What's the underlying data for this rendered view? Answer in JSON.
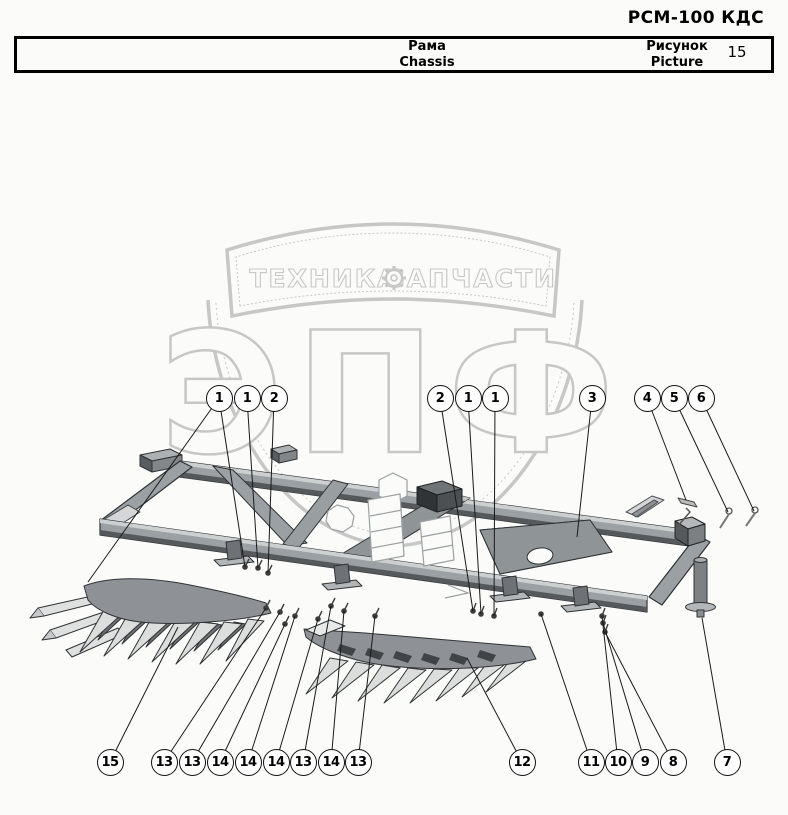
{
  "header": {
    "title": "РСМ-100 КДС"
  },
  "info_table": {
    "part_name_ru": "Рама",
    "part_name_en": "Chassis",
    "figure_label_ru": "Рисунок",
    "figure_label_en": "Picture",
    "figure_number": "15"
  },
  "watermark": {
    "banner_left": "ТЕХНИКА",
    "banner_right": "ЗАПЧАСТИ",
    "logo_text": "ЭПФ",
    "gear_icon": "gear",
    "color": "#c7c7c7"
  },
  "colors": {
    "frame": "#9aa0a3",
    "frame_dark": "#5b5f62",
    "frame_light": "#cdd0d1",
    "outline": "#2f3336",
    "leader": "#1a1a1a",
    "teeth_light": "#dcdedd",
    "teeth_dark": "#6d7174"
  },
  "callouts": [
    {
      "label": "1",
      "x": 219,
      "y": 398,
      "targets": [
        [
          245,
          567
        ],
        [
          88,
          582
        ]
      ]
    },
    {
      "label": "1",
      "x": 247,
      "y": 398,
      "targets": [
        [
          258,
          568
        ]
      ]
    },
    {
      "label": "2",
      "x": 274,
      "y": 398,
      "targets": [
        [
          268,
          573
        ]
      ]
    },
    {
      "label": "2",
      "x": 440,
      "y": 398,
      "targets": [
        [
          473,
          611
        ]
      ]
    },
    {
      "label": "1",
      "x": 468,
      "y": 398,
      "targets": [
        [
          481,
          614
        ]
      ]
    },
    {
      "label": "1",
      "x": 495,
      "y": 398,
      "targets": [
        [
          494,
          616
        ]
      ]
    },
    {
      "label": "3",
      "x": 592,
      "y": 398,
      "targets": [
        [
          577,
          537
        ]
      ]
    },
    {
      "label": "4",
      "x": 647,
      "y": 398,
      "targets": [
        [
          686,
          500
        ]
      ]
    },
    {
      "label": "5",
      "x": 674,
      "y": 398,
      "targets": [
        [
          728,
          512
        ]
      ]
    },
    {
      "label": "6",
      "x": 701,
      "y": 398,
      "targets": [
        [
          754,
          511
        ]
      ]
    },
    {
      "label": "15",
      "x": 110,
      "y": 762,
      "targets": [
        [
          178,
          627
        ]
      ]
    },
    {
      "label": "13",
      "x": 164,
      "y": 762,
      "targets": [
        [
          266,
          608
        ]
      ]
    },
    {
      "label": "13",
      "x": 192,
      "y": 762,
      "targets": [
        [
          280,
          612
        ]
      ]
    },
    {
      "label": "14",
      "x": 220,
      "y": 762,
      "targets": [
        [
          285,
          624
        ]
      ]
    },
    {
      "label": "14",
      "x": 248,
      "y": 762,
      "targets": [
        [
          295,
          616
        ]
      ]
    },
    {
      "label": "14",
      "x": 276,
      "y": 762,
      "targets": [
        [
          318,
          619
        ]
      ]
    },
    {
      "label": "13",
      "x": 303,
      "y": 762,
      "targets": [
        [
          331,
          606
        ]
      ]
    },
    {
      "label": "14",
      "x": 331,
      "y": 762,
      "targets": [
        [
          344,
          611
        ]
      ]
    },
    {
      "label": "13",
      "x": 358,
      "y": 762,
      "targets": [
        [
          375,
          616
        ]
      ]
    },
    {
      "label": "12",
      "x": 522,
      "y": 762,
      "targets": [
        [
          467,
          658
        ]
      ]
    },
    {
      "label": "11",
      "x": 591,
      "y": 762,
      "targets": [
        [
          541,
          614
        ]
      ]
    },
    {
      "label": "10",
      "x": 618,
      "y": 762,
      "targets": [
        [
          602,
          616
        ]
      ]
    },
    {
      "label": "9",
      "x": 645,
      "y": 762,
      "targets": [
        [
          603,
          623
        ]
      ]
    },
    {
      "label": "8",
      "x": 673,
      "y": 762,
      "targets": [
        [
          605,
          632
        ]
      ]
    },
    {
      "label": "7",
      "x": 727,
      "y": 762,
      "targets": [
        [
          702,
          618
        ]
      ]
    }
  ]
}
